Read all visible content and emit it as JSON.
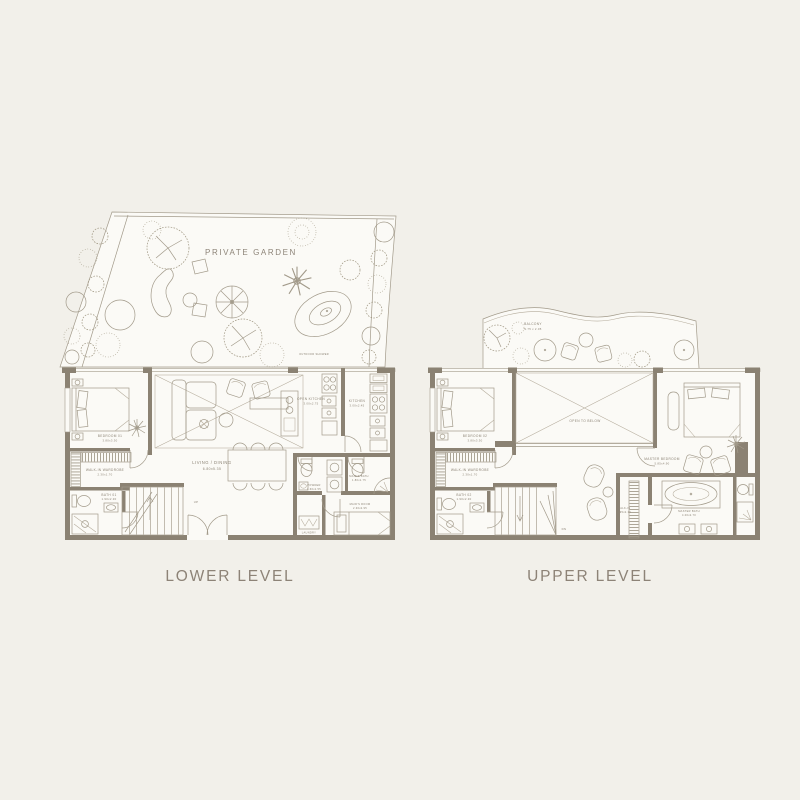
{
  "palette": {
    "background": "#f2f0ea",
    "floor": "#fbfaf6",
    "wall": "#8b8273",
    "line": "#a29a8a",
    "text": "#8c8375"
  },
  "lower_level": {
    "title": "LOWER LEVEL",
    "garden": {
      "label": "PRIVATE GARDEN",
      "outdoor_shower_label": "OUTDOOR SHOWER"
    },
    "rooms": {
      "bedroom1": {
        "name": "BEDROOM 01",
        "dims": "3.80x3.30"
      },
      "wardrobe1": {
        "name": "WALK-IN WARDROBE",
        "dims": "2.30x1.70"
      },
      "bath1": {
        "name": "BATH 01",
        "dims": "1.90x2.30"
      },
      "living": {
        "name": "LIVING / DINING",
        "dims": "6.80x5.35"
      },
      "open_kitchen": {
        "name": "OPEN KITCHEN",
        "dims": "3.00x2.75"
      },
      "kitchen": {
        "name": "KITCHEN",
        "dims": "3.00x2.45"
      },
      "powder": {
        "name": "POWDER",
        "dims": "1.60x1.55"
      },
      "maids_bath": {
        "name": "MAID'S BATH",
        "dims": "1.80x1.75"
      },
      "maids_room": {
        "name": "MAID'S ROOM",
        "dims": "2.30x2.95"
      },
      "laundry": {
        "name": "LAUNDRY"
      },
      "stairs": {
        "label": "UP"
      }
    }
  },
  "upper_level": {
    "title": "UPPER LEVEL",
    "balcony": {
      "name": "BALCONY",
      "dims": "9.75 x 2.05"
    },
    "rooms": {
      "bedroom2": {
        "name": "BEDROOM 02",
        "dims": "3.80x3.30"
      },
      "wardrobe2": {
        "name": "WALK-IN WARDROBE",
        "dims": "2.30x1.70"
      },
      "bath2": {
        "name": "BATH 02",
        "dims": "1.90x2.30"
      },
      "open_to_below": {
        "name": "OPEN TO BELOW"
      },
      "master_bedroom": {
        "name": "MASTER BEDROOM",
        "dims": "5.85x4.90"
      },
      "walk_in": {
        "name": "WALK-IN",
        "dims": "1.95x2.10"
      },
      "master_bath": {
        "name": "MASTER BATH",
        "dims": "4.00x2.70"
      },
      "stairs": {
        "label": "DN"
      }
    }
  }
}
